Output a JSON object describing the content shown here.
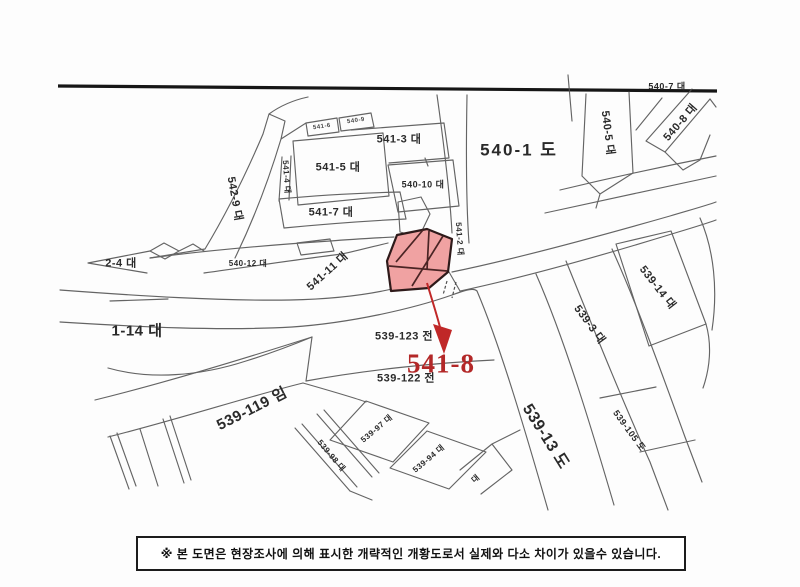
{
  "map": {
    "type": "cadastral-sketch-map",
    "highlight": {
      "parcel": "541-8",
      "fill_color": "#f0a2a2",
      "outline_color": "#2e1a1a",
      "arrow_color": "#c02828",
      "callout_color": "#b32828"
    },
    "parcels": {
      "p540_7": {
        "text": "540-7 대"
      },
      "p540_5": {
        "text": "540-5 대"
      },
      "p540_8": {
        "text": "540-8 대"
      },
      "p540_1": {
        "text": "540-1 도"
      },
      "p541_3": {
        "text": "541-3 대"
      },
      "p541_5": {
        "text": "541-5 대"
      },
      "p540_10": {
        "text": "540-10 대"
      },
      "p541_7": {
        "text": "541-7 대"
      },
      "p542_9": {
        "text": "542-9 대"
      },
      "p541_4": {
        "text": "541-4 대"
      },
      "p2_4": {
        "text": "2-4 대"
      },
      "p540_12": {
        "text": "540-12 대"
      },
      "p541_11": {
        "text": "541-11 대"
      },
      "p541_2": {
        "text": "541-2 대"
      },
      "p539_123": {
        "text": "539-123 전"
      },
      "p541_8": {
        "text": "541-8"
      },
      "p539_122": {
        "text": "539-122 전"
      },
      "p1_14": {
        "text": "1-14 대"
      },
      "p539_119": {
        "text": "539-119 임"
      },
      "p539_14": {
        "text": "539-14 대"
      },
      "p539_3": {
        "text": "539-3 대"
      },
      "p539_105": {
        "text": "539-105 도"
      },
      "p539_13": {
        "text": "539-13 도"
      },
      "p539_98": {
        "text": "539-98 대"
      },
      "p539_97": {
        "text": "539-97 대"
      },
      "p539_94": {
        "text": "539-94 대"
      },
      "p_dae": {
        "text": "대"
      },
      "tiny_1": {
        "text": "541-6"
      },
      "tiny_2": {
        "text": "540-9"
      }
    }
  },
  "note": {
    "text": "※ 본 도면은 현장조사에 의해 표시한 개략적인 개황도로서 실제와 다소 차이가 있을수 있습니다."
  }
}
